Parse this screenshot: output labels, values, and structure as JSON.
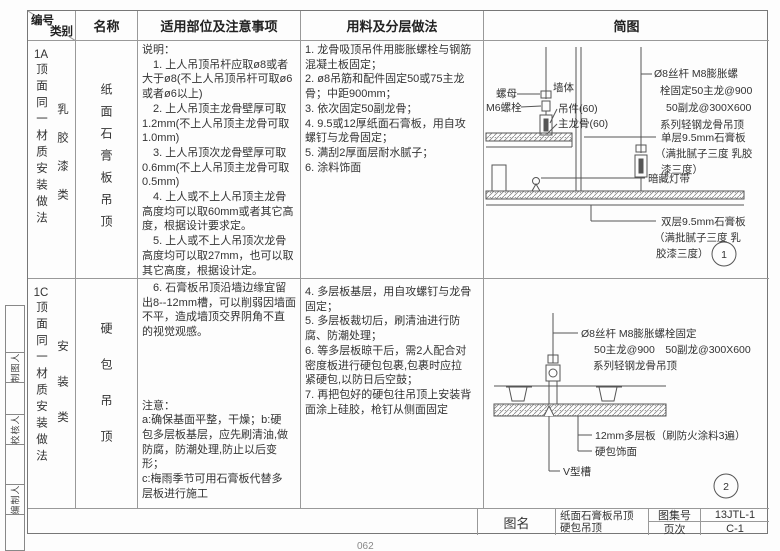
{
  "header": {
    "no": "编号",
    "category": "类别",
    "name": "名称",
    "notes": "适用部位及注意事项",
    "materials": "用料及分层做法",
    "diagram": "简图"
  },
  "rows": [
    {
      "no": "1A",
      "no_label": "顶面同一材质安装做法",
      "category": "乳胶漆类",
      "name": "纸面石膏板吊顶",
      "notes": "说明：\n　1. 上人吊顶吊杆应取ø8或者\n大于ø8(不上人吊顶吊杆可取ø6\n或者ø6以上)\n　2. 上人吊顶主龙骨壁厚可取\n1.2mm(不上人吊顶主龙骨可取\n1.0mm)\n　3. 上人吊顶次龙骨壁厚可取\n0.6mm(不上人吊顶主龙骨可取\n0.5mm)\n　4. 上人或不上人吊顶主龙骨\n高度均可以取60mm或者其它高\n度，根据设计要求定。\n　5. 上人或不上人吊顶次龙骨\n高度均可以取27mm，也可以取\n其它高度，根据设计定。",
      "materials": "1. 龙骨吸顶吊件用膨胀螺栓与钢筋\n混凝土板固定；\n2. ø8吊筋和配件固定50或75主龙\n骨；中距900mm；\n3. 依次固定50副龙骨；\n4. 9.5或12厚纸面石膏板，用自攻\n螺钉与龙骨固定；\n5. 满刮2厚面层耐水腻子；\n6. 涂料饰面"
    },
    {
      "no": "1C",
      "no_label": "顶面同一材质安装做法",
      "category": "安装类",
      "name": "硬包吊顶",
      "notes": "　6. 石膏板吊顶沿墙边缘宜留\n出8--12mm槽，可以削弱因墙面\n不平，造成墙顶交界阴角不直\n的视觉观感。\n\n\n\n\n注意：\na:确保基面平整，干燥；b:硬\n包多层板基层，应先刷清油,做\n防腐，防潮处理,防止以后变形；\nc:梅雨季节可用石膏板代替多\n层板进行施工",
      "materials": "4. 多层板基层，用自攻螺钉与龙骨\n固定；\n5. 多层板裁切后，刷清油进行防\n腐、防潮处理；\n6. 等多层板晾干后，需2人配合对\n密度板进行硬包包裹,包裹时应拉\n紧硬包,以防日后空鼓；\n7. 再把包好的硬包往吊顶上安装背\n面涂上硅胶，枪钉从侧面固定"
    }
  ],
  "diagram1": {
    "nut": "螺母",
    "bolt": "M6螺栓",
    "wall": "墙体",
    "hanger": "吊件(60)",
    "main_runner": "主龙骨(60)",
    "rod_note_1": "Ø8丝杆 M8膨胀螺",
    "rod_note_2": "栓固定50主龙@900",
    "rod_note_3": "50副龙@300X600",
    "rod_note_4": "系列轻钢龙骨吊顶",
    "single_board_1": "单层9.5mm石膏板",
    "single_board_2": "（满批腻子三度 乳胶",
    "single_board_3": "漆三度）",
    "cove_light": "暗藏灯带",
    "double_board_1": "双层9.5mm石膏板",
    "double_board_2": "（满批腻子三度 乳",
    "double_board_3": "胶漆三度）",
    "number": "1"
  },
  "diagram2": {
    "rod_note_1": "Ø8丝杆 M8膨胀螺栓固定",
    "rod_note_2": "50主龙@900　50副龙@300X600",
    "rod_note_3": "系列轻钢龙骨吊顶",
    "plywood": "12mm多层板（刷防火涂料3遍）",
    "upholstery": "硬包饰面",
    "v_groove": "V型槽",
    "number": "2"
  },
  "signoff": {
    "drafter": "制图人",
    "checker": "校核人",
    "compiler": "编制人"
  },
  "titleblock": {
    "name_label": "图名",
    "name_line1": "纸面石膏板吊顶",
    "name_line2": "硬包吊顶",
    "atlas_label": "图集号",
    "atlas_value": "13JTL-1",
    "page_label": "页次",
    "page_value": "C-1"
  },
  "footer": {
    "page_number": "062"
  }
}
